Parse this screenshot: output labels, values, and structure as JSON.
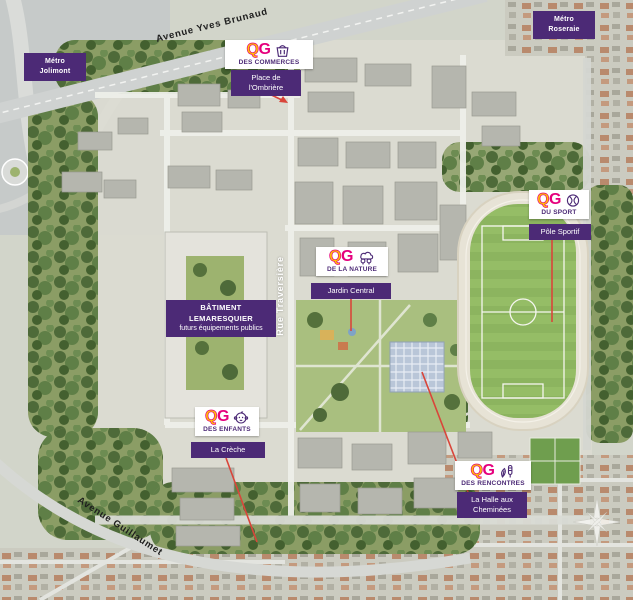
{
  "title": "Guillaumet district masterplan aerial map",
  "streets": {
    "avenue_top": "Avenue Yves Brunaud",
    "avenue_bottom": "Avenue Guillaumet",
    "rue_center": "Rue Traversière"
  },
  "metro": {
    "jolimont": {
      "line1": "Métro",
      "line2": "Jolimont"
    },
    "roseraie": {
      "line1": "Métro",
      "line2": "Roseraie"
    }
  },
  "qg": [
    {
      "logo_q": "Q",
      "logo_g": "G",
      "subtitle": "DES COMMERCES",
      "badge_line1": "Place de",
      "badge_line2": "l'Ombrière",
      "icon": "shopping-basket-icon"
    },
    {
      "logo_q": "Q",
      "logo_g": "G",
      "subtitle": "DE LA NATURE",
      "badge": "Jardin Central",
      "icon": "tree-cloud-icon"
    },
    {
      "logo_q": "Q",
      "logo_g": "G",
      "subtitle": "DU SPORT",
      "badge": "Pôle Sportif",
      "icon": "tennis-ball-icon"
    },
    {
      "logo_q": "Q",
      "logo_g": "G",
      "subtitle": "DES ENFANTS",
      "badge": "La Crèche",
      "icon": "baby-face-icon"
    },
    {
      "logo_q": "Q",
      "logo_g": "G",
      "subtitle": "DES RENCONTRES",
      "badge_line1": "La Halle aux",
      "badge_line2": "Cheminées",
      "icon": "leaf-chimney-icon"
    }
  ],
  "building": {
    "line1": "BÂTIMENT LEMARESQUIER",
    "line2": "futurs équipements publics"
  },
  "colors": {
    "badge_purple": "#4c2a76",
    "logo_magenta": "#e5007d",
    "logo_yellow": "#ffc400",
    "leader_red": "#d9453a",
    "field_green": "#8cb45f"
  }
}
